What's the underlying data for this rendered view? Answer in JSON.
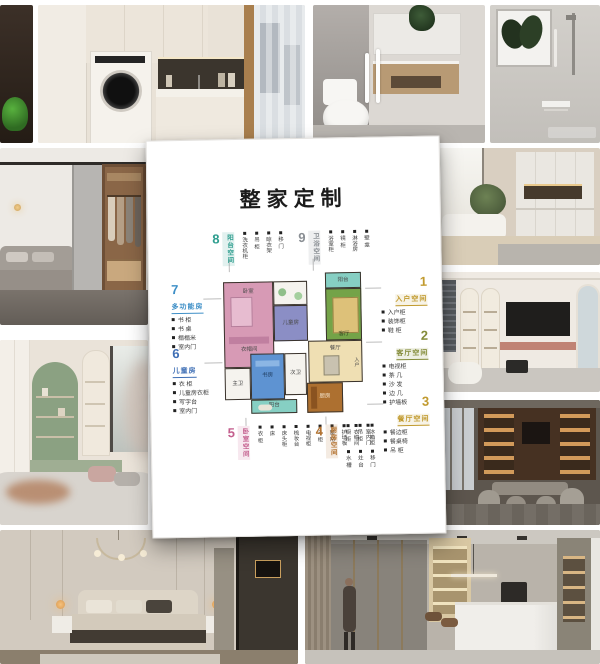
{
  "card": {
    "title": "整家定制",
    "sections": [
      {
        "num": "1",
        "title": "入户空间",
        "color": "#c19a2e",
        "items": [
          "入户柜",
          "装饰柜",
          "鞋 柜"
        ]
      },
      {
        "num": "2",
        "title": "客厅空间",
        "color": "#848c3a",
        "items": [
          "电视柜",
          "茶 几",
          "沙 发",
          "边 几",
          "护墙板"
        ]
      },
      {
        "num": "3",
        "title": "餐厅空间",
        "color": "#c19a2e",
        "items": [
          "餐边柜",
          "餐桌椅",
          "吊 柜"
        ]
      },
      {
        "num": "4",
        "title": "厨房空间",
        "color": "#b3722f",
        "items": [
          "橱 柜",
          "吊 柜",
          "冰箱柜",
          "水 槽",
          "灶 台",
          "移 门"
        ]
      },
      {
        "num": "5",
        "title": "卧室空间",
        "color": "#c45f8e",
        "items": [
          "衣 柜",
          "床",
          "床头柜",
          "梳妆台",
          "电视柜",
          "斗 柜",
          "窗 帘",
          "护墙板",
          "衣帽间",
          "室内门"
        ]
      },
      {
        "num": "6",
        "title": "儿童房",
        "color": "#3f6fb5",
        "items": [
          "衣 柜",
          "儿童房衣柜",
          "写字台",
          "室内门"
        ]
      },
      {
        "num": "7",
        "title": "多功能房",
        "color": "#3e8fc7",
        "items": [
          "书 柜",
          "书 桌",
          "榻榻米",
          "室内门"
        ]
      },
      {
        "num": "8",
        "title": "阳台空间",
        "color": "#2f9e8f",
        "items": [
          "洗衣机柜",
          "吊 柜",
          "晾衣架",
          "移 门"
        ]
      },
      {
        "num": "9",
        "title": "卫浴空间",
        "color": "#8a8f94",
        "items": [
          "浴室柜",
          "镜 柜",
          "淋浴房",
          "壁 龛"
        ]
      }
    ],
    "floorplan": {
      "rooms": {
        "bedroom": "卧室",
        "cloakroom": "衣帽间",
        "kids": "儿童房",
        "living": "客厅",
        "dining": "餐厅",
        "kitchen": "厨房",
        "study": "书房",
        "balcony_top": "阳台",
        "balcony_bottom": "阳台",
        "bath_left": "主卫",
        "bath_center": "次卫",
        "entry": "入户"
      },
      "room_colors": {
        "bedroom": "#d79ab5",
        "kids": "#8b8ec5",
        "living": "#74a348",
        "living_inner": "#ddc179",
        "dining": "#efdfb3",
        "kitchen": "#ad7030",
        "study": "#5e93d2",
        "balcony": "#86cfc3",
        "bath": "#f5f3ee",
        "wall": "#3a332c"
      }
    }
  }
}
